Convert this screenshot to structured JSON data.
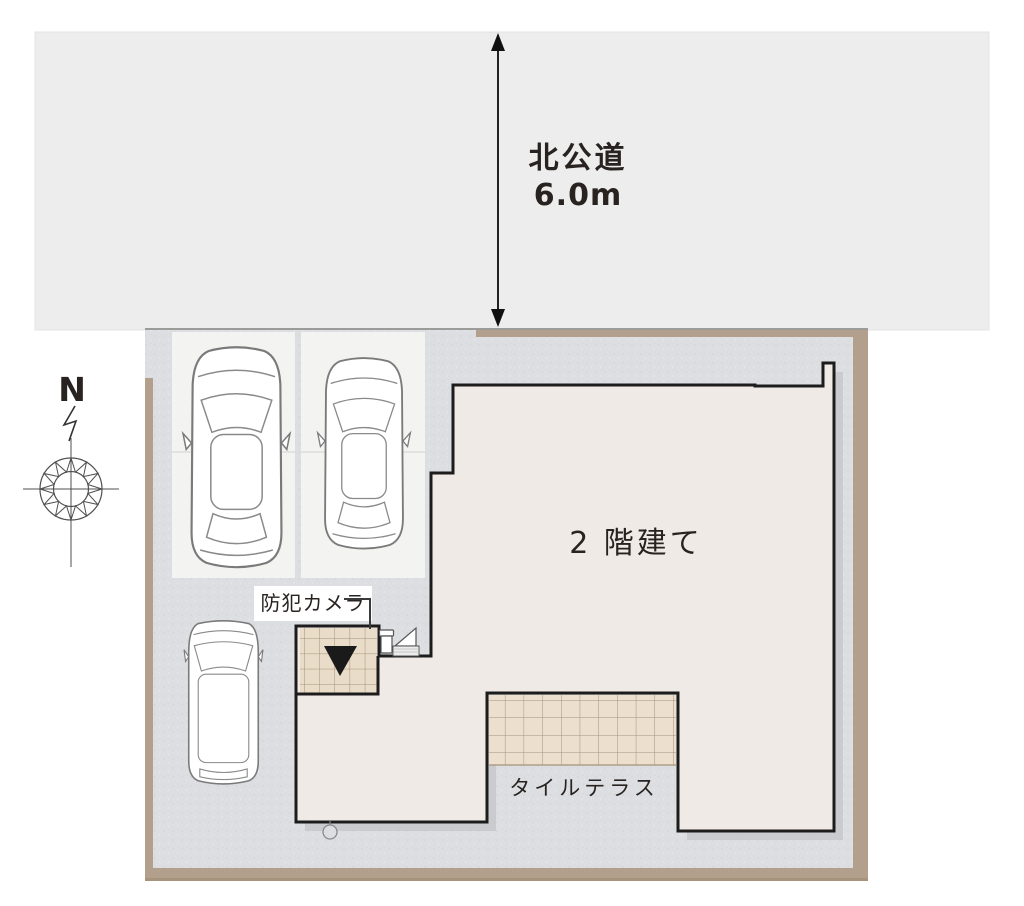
{
  "title": "site-plan",
  "road": {
    "name": "北公道",
    "width_dimension": "6.0m"
  },
  "compass": {
    "north_label": "N"
  },
  "building": {
    "label": "2 階建て",
    "stories": 2
  },
  "annotations": {
    "security_camera": "防犯カメラ",
    "tile_terrace": "タイルテラス"
  },
  "icons": {
    "dimension-arrow-icon": "↕ double-headed measure arrow",
    "compass-rose-icon": "12-point star compass rose with crosshair",
    "north-zigzag-icon": "↯ bent north pointer",
    "entrance-marker-icon": "▼",
    "security-camera-icon": "wall camera with sensor box",
    "sedan-car-icon": "car top view",
    "hatchback-car-icon": "car top view",
    "van-car-icon": "van top view",
    "water-tap-icon": "○ ground fixture"
  },
  "colors": {
    "page_bg": "#ffffff",
    "road_fill": "#ededee",
    "ground_fill": "#dcdee1",
    "boundary_tan": "#b3a08c",
    "building_fill": "#efeae6",
    "building_outline": "#1c1c1c",
    "tile_fill": "#e9dcc8",
    "tile_grid": "#a5927a",
    "parking_stall_fill": "#f3f3f1",
    "shadow": "#c6c8cb",
    "text": "#282320"
  }
}
